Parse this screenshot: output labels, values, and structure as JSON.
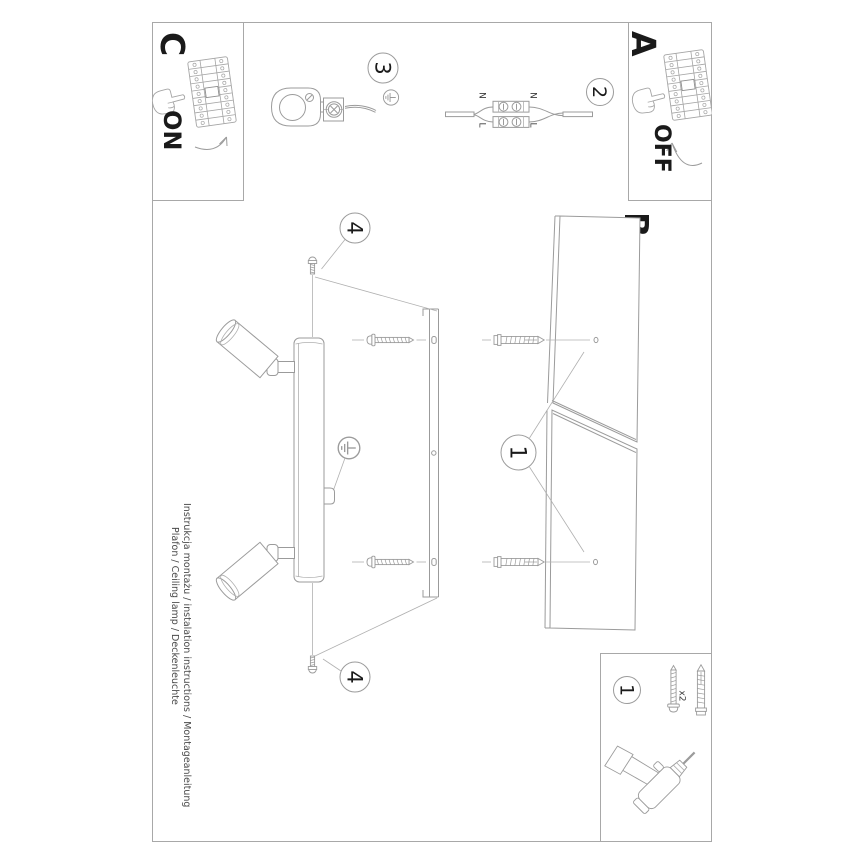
{
  "sheet": {
    "footer": {
      "line1": "Instrukcja montażu / instalation instructions / Montageanleitung",
      "line2": "Plafon / Ceiling lamp / Deckenleuchte"
    },
    "steps": {
      "a_label": "A",
      "a_state": "OFF",
      "b_label": "B",
      "c_label": "C",
      "c_state": "ON"
    },
    "callouts": {
      "drill": "1",
      "wires": "2",
      "canopy": "3",
      "fix_screws": "4"
    },
    "wire_labels": {
      "neutral": "N",
      "live": "L"
    },
    "parts_box": {
      "dowel_qty": "x2"
    },
    "colors": {
      "background": "#ffffff",
      "line": "#9b9b9b",
      "border": "#a8a8a8",
      "text": "#1a1a1a",
      "muted_text": "#4a4a4a"
    }
  }
}
